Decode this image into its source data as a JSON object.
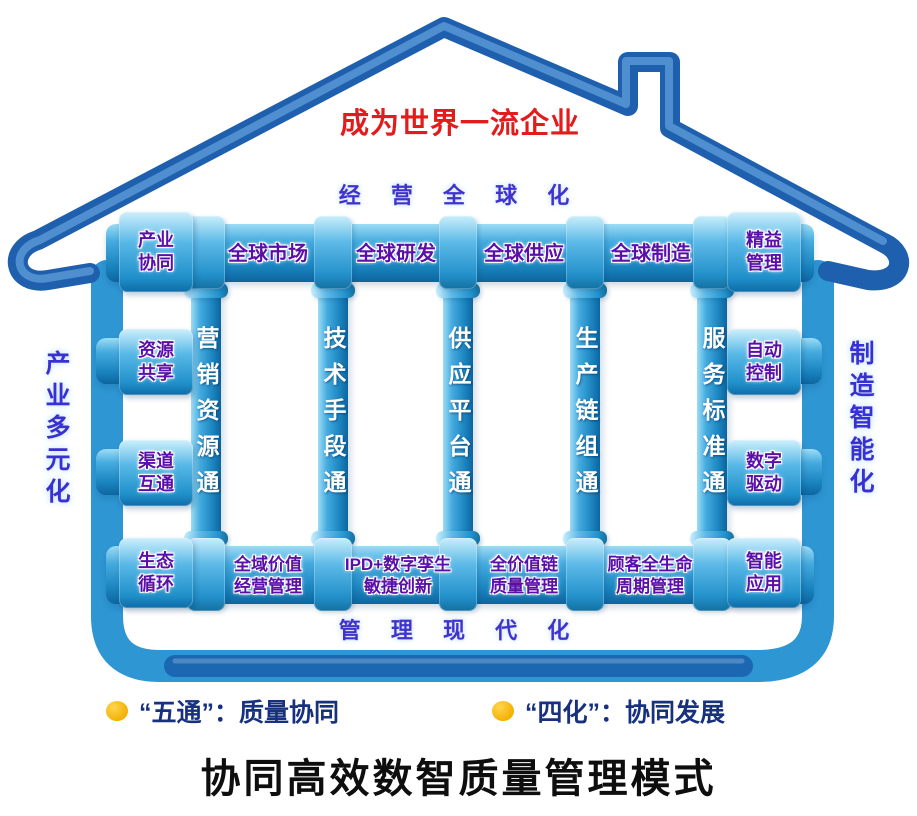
{
  "title": "协同高效数智质量管理模式",
  "vision": "成为世界一流企业",
  "banners": {
    "top": "经 营 全 球 化",
    "bottom": "管 理 现 代 化",
    "left": "产业多元化",
    "right": "制造智能化"
  },
  "top_row": {
    "left_joint": "产业\n协同",
    "segments": [
      "全球市场",
      "全球研发",
      "全球供应",
      "全球制造"
    ],
    "right_joint": "精益\n管理"
  },
  "columns": [
    "营销资源通",
    "技术手段通",
    "供应平台通",
    "生产链组通",
    "服务标准通"
  ],
  "side_boxes": {
    "left": [
      "资源\n共享",
      "渠道\n互通"
    ],
    "right": [
      "自动\n控制",
      "数字\n驱动"
    ]
  },
  "bottom_row": {
    "left_joint": "生态\n循环",
    "segments": [
      "全域价值\n经营管理",
      "IPD+数字孪生\n敏捷创新",
      "全价值链\n质量管理",
      "顾客全生命\n周期管理"
    ],
    "right_joint": "智能\n应用"
  },
  "legend": [
    {
      "label": "“五通”：质量协同"
    },
    {
      "label": "“四化”：协同发展"
    }
  ],
  "colors": {
    "roof_pipe": "#1e5fae",
    "wall_pipe": "#2e96d3",
    "label_purple": "#5a10a8",
    "banner_blue": "#4331cd",
    "vision_red": "#e31b1b",
    "legend_blue": "#17317f",
    "bullet_yellow": "#f3b105"
  }
}
